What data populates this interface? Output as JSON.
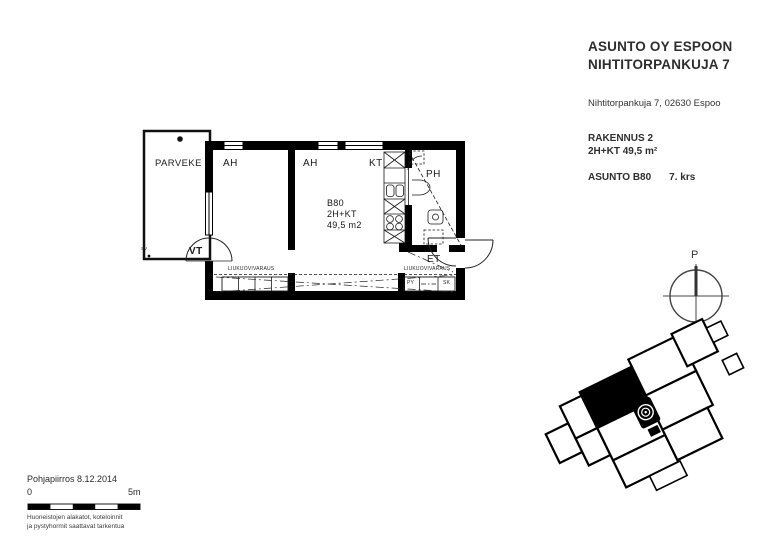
{
  "title_block": {
    "company_line1": "ASUNTO OY ESPOON",
    "company_line2": "NIHTITORPANKUJA 7",
    "address": "Nihtitorpankuja 7, 02630 Espoo",
    "building": "RAKENNUS 2",
    "apartment_type": "2H+KT 49,5 m²",
    "apartment_label": "ASUNTO B80",
    "floor": "7. krs"
  },
  "floor_plan": {
    "rooms": {
      "balcony": "PARVEKE",
      "room1": "AH",
      "room2": "AH",
      "kitchen": "KT",
      "bathroom": "PH",
      "entrance": "ET",
      "balcony_door": "VT",
      "sv_mark": "SV"
    },
    "unit": {
      "id": "B80",
      "type": "2H+KT",
      "area": "49,5 m2"
    },
    "annotations": {
      "sliding_door_left": "LIUKUOVIVARAUS",
      "sliding_door_right": "LIUKUOVIVARAUS",
      "closet_py": "PY",
      "closet_sk": "SK"
    }
  },
  "compass": {
    "north_label": "P"
  },
  "footer": {
    "drawing_title": "Pohjapiirros 8.12.2014",
    "scale_start": "0",
    "scale_end": "5m",
    "note_line1": "Huoneistojen alakatot, koteloinnit",
    "note_line2": "ja pystyhormit saattavat tarkentua"
  },
  "colors": {
    "ink": "#1a1a1a",
    "wall": "#000000"
  }
}
